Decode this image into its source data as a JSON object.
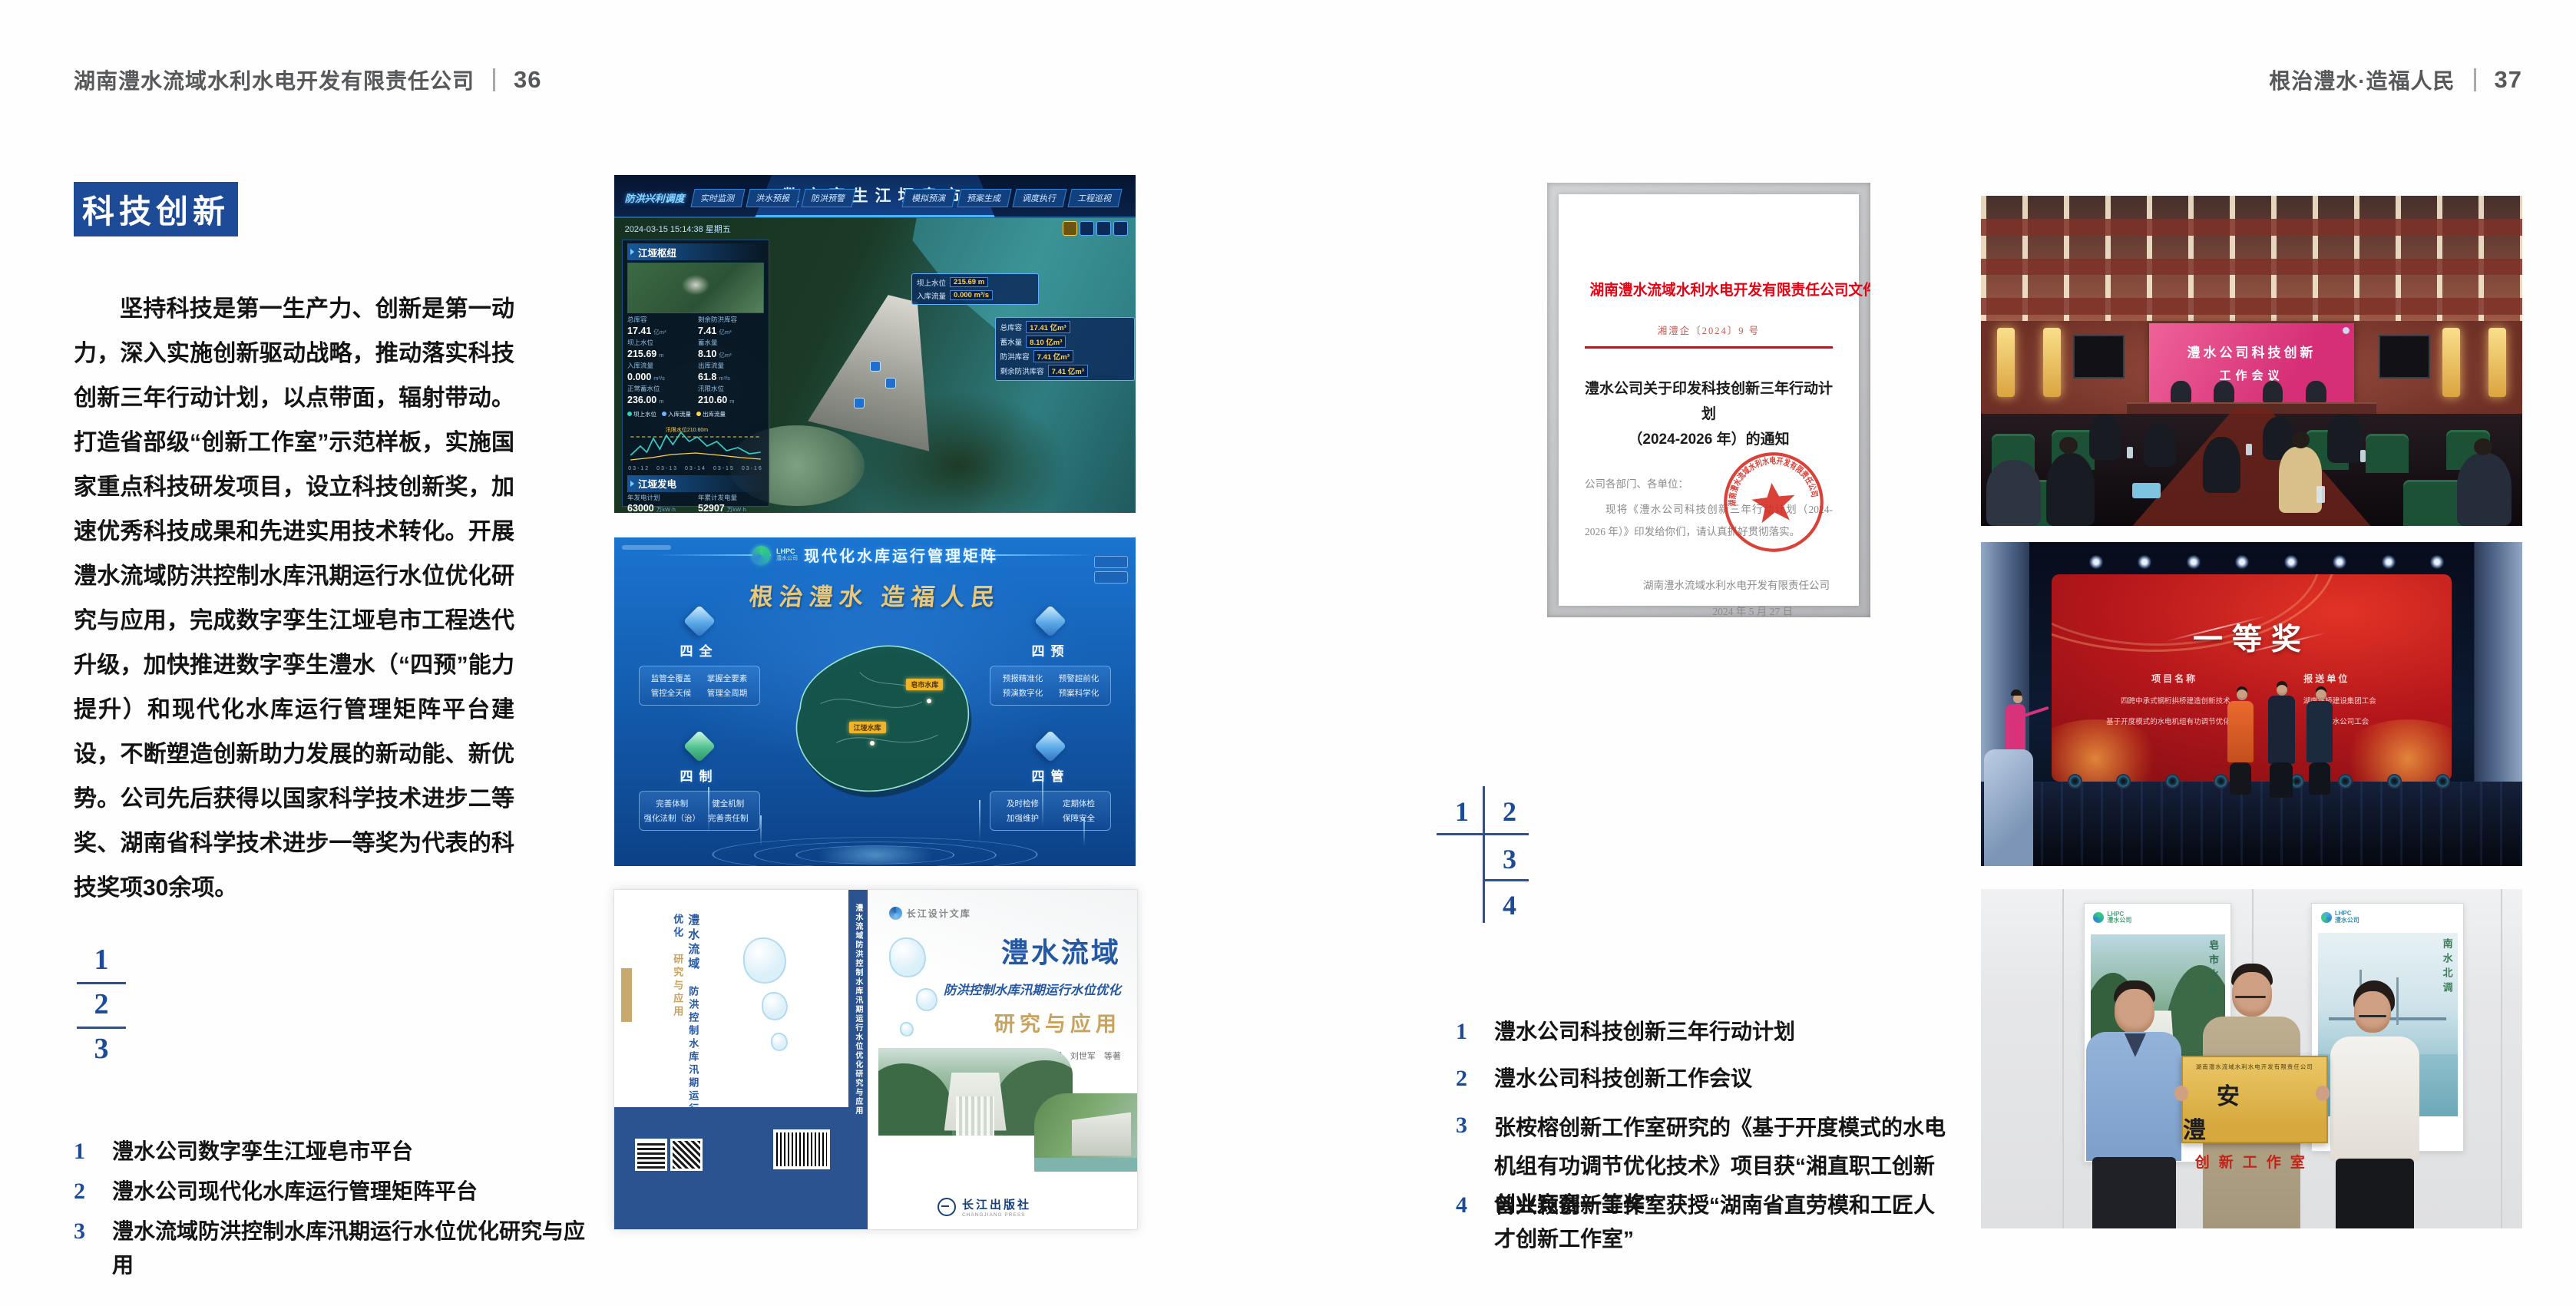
{
  "spread": {
    "left_header": {
      "company": "湖南澧水流域水利水电开发有限责任公司",
      "page": "36"
    },
    "right_header": {
      "slogan": "根治澧水·造福人民",
      "page": "37"
    },
    "badge": "科技创新",
    "paragraph": "坚持科技是第一生产力、创新是第一动力，深入实施创新驱动战略，推动落实科技创新三年行动计划，以点带面，辐射带动。打造省部级“创新工作室”示范样板，实施国家重点科技研发项目，设立科技创新奖，加速优秀科技成果和先进实用技术转化。开展澧水流域防洪控制水库汛期运行水位优化研究与应用，完成数字孪生江垭皂市工程迭代升级，加快推进数字孪生澧水（“四预”能力提升）和现代化水库运行管理矩阵平台建设，不断塑造创新助力发展的新动能、新优势。公司先后获得以国家科学技术进步二等奖、湖南省科学技术进步一等奖为代表的科技奖项30余项。",
    "left_index": {
      "n1": "1",
      "n2": "2",
      "n3": "3"
    },
    "right_index": {
      "n1": "1",
      "n2": "2",
      "n3": "3",
      "n4": "4"
    },
    "left_captions": [
      {
        "num": "1",
        "text": "澧水公司数字孪生江垭皂市平台"
      },
      {
        "num": "2",
        "text": "澧水公司现代化水库运行管理矩阵平台"
      },
      {
        "num": "3",
        "text": "澧水流域防洪控制水库汛期运行水位优化研究与应用"
      }
    ],
    "right_captions": [
      {
        "num": "1",
        "text": "澧水公司科技创新三年行动计划"
      },
      {
        "num": "2",
        "text": "澧水公司科技创新工作会议"
      },
      {
        "num": "3",
        "text": "张桉榕创新工作室研究的《基于开度模式的水电机组有功调节优化技术》项目获“湘直职工创新创业竞赛一等奖”"
      },
      {
        "num": "4",
        "text": "曾兴颖创新工作室获授“湖南省直劳模和工匠人才创新工作室”"
      }
    ]
  },
  "twin": {
    "title": "数字孪生江垭皂市",
    "menu": "防洪兴利调度",
    "tabs_left": [
      "实时监测",
      "洪水预报",
      "防洪预警"
    ],
    "tabs_right": [
      "模拟预演",
      "预案生成",
      "调度执行",
      "工程巡视"
    ],
    "datetime": "2024-03-15 15:14:38 星期五",
    "hub_title": "江垭枢纽",
    "hub_stats": [
      {
        "label": "总库容",
        "value": "17.41",
        "unit": "亿m³"
      },
      {
        "label": "剩余防洪库容",
        "value": "7.41",
        "unit": "亿m³"
      },
      {
        "label": "坝上水位",
        "value": "215.69",
        "unit": "m"
      },
      {
        "label": "蓄水量",
        "value": "8.10",
        "unit": "亿m³"
      },
      {
        "label": "入库流量",
        "value": "0.000",
        "unit": "m³/s"
      },
      {
        "label": "出库流量",
        "value": "61.8",
        "unit": "m³/s"
      },
      {
        "label": "正常蓄水位",
        "value": "236.00",
        "unit": "m"
      },
      {
        "label": "汛限水位",
        "value": "210.60",
        "unit": "m"
      }
    ],
    "legend": [
      "坝上水位",
      "入库流量",
      "出库流量"
    ],
    "chart_note": "汛限水位210.60m",
    "xaxis": "03-12　03-13　03-14　03-15　03-16",
    "gen_title": "江垭发电",
    "gen_stats": [
      {
        "label": "年发电计划",
        "value": "63000",
        "unit": "万kW·h"
      },
      {
        "label": "年累计发电量",
        "value": "52907",
        "unit": "万kW·h"
      },
      {
        "label": "月累计发电量",
        "value": "3259.21",
        "unit": "万kW·h"
      },
      {
        "label": "当前出力",
        "value": "0.00",
        "unit": "MW"
      },
      {
        "label": "发电流量",
        "value": "0.00",
        "unit": "m³/s"
      },
      {
        "label": "弃水流量",
        "value": "0.00",
        "unit": "m³/s"
      }
    ],
    "units": [
      {
        "name": "1号机组",
        "value": "0.00"
      },
      {
        "name": "2号机组",
        "value": "100.58"
      },
      {
        "name": "3号机组",
        "value": "0.00"
      }
    ],
    "callout1": [
      {
        "label": "坝上水位",
        "value": "215.69 m"
      },
      {
        "label": "入库流量",
        "value": "0.000 m³/s"
      }
    ],
    "callout2": [
      {
        "label": "总库容",
        "value": "17.41 亿m³"
      },
      {
        "label": "蓄水量",
        "value": "8.10 亿m³"
      },
      {
        "label": "防洪库容",
        "value": "7.41 亿m³"
      },
      {
        "label": "剩余防洪库容",
        "value": "7.41 亿m³"
      }
    ]
  },
  "matrix": {
    "logo_text": "LHPC",
    "logo_sub": "澧水公司",
    "title": "现代化水库运行管理矩阵",
    "slogan": "根治澧水  造福人民",
    "corner_tl": {
      "name": "四全",
      "items": [
        "监管全覆盖",
        "掌握全要素",
        "管控全天候",
        "管理全周期"
      ]
    },
    "corner_tr": {
      "name": "四预",
      "items": [
        "预报精准化",
        "预警超前化",
        "预演数字化",
        "预案科学化"
      ]
    },
    "corner_bl": {
      "name": "四制",
      "items": [
        "完善体制",
        "健全机制",
        "强化法制（治）",
        "完善责任制"
      ]
    },
    "corner_br": {
      "name": "四管",
      "items": [
        "及时检修",
        "定期体检",
        "加强维护",
        "保障安全"
      ]
    },
    "map_label1": "皂市水库",
    "map_label2": "江垭水库"
  },
  "book": {
    "series": "长江设计文库",
    "title1": "澧水流域",
    "title2": "防洪控制水库汛期运行水位优化",
    "title3": "研究与应用",
    "authors": "洪兴骏　沈坤民　鲁军　刘世军　等著",
    "publisher": "长江出版社",
    "publisher_sub": "CHANGJIANG PRESS",
    "spine": "澧水流域防洪控制水库汛期运行水位优化研究与应用",
    "back_title1": "澧水流域",
    "back_title2": "防洪控制水库汛期运行水位优化",
    "back_title3": "研究与应用"
  },
  "doc": {
    "header": "湖南澧水流域水利水电开发有限责任公司文件",
    "number": "湘澧企〔2024〕9 号",
    "title1": "澧水公司关于印发科技创新三年行动计划",
    "title2": "（2024-2026 年）的通知",
    "salutation": "公司各部门、各单位：",
    "body": "现将《澧水公司科技创新三年行动计划（2024-2026 年）》印发给你们，请认真抓好贯彻落实。",
    "signer": "湖南澧水流域水利水电开发有限责任公司",
    "date": "2024 年 5 月 27 日",
    "seal_text": "湖南澧水流域水利水电开发有限责任公司"
  },
  "meeting": {
    "screen1": "澧水公司科技创新",
    "screen2": "工作会议"
  },
  "award": {
    "title": "一等奖",
    "col1": "项目名称",
    "col2": "报送单位",
    "p1": "四跨中承式钢桁拱桥建造创新技术",
    "p2": "基于开度模式的水电机组有功调节优化技术",
    "u1": "湖南路桥建设集团工会",
    "u2": "湖南澧水公司工会"
  },
  "plaque": {
    "logo": "LHPC",
    "logo_sub": "澧水公司",
    "poster1_text": "皂市水库",
    "poster2_text": "南水北调",
    "header": "湖南澧水流域水利水电开发有限责任公司",
    "name": "安澧",
    "sub": "创新工作室"
  }
}
